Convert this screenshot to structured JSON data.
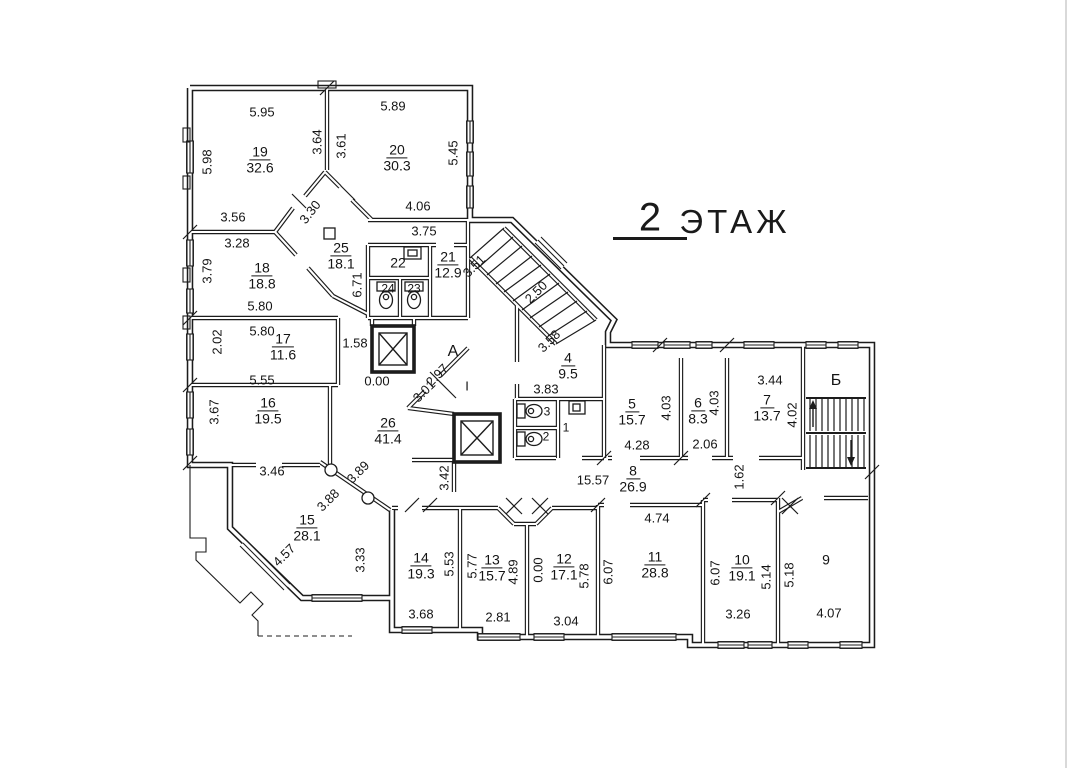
{
  "title": {
    "number": "2",
    "word": "ЭТАЖ"
  },
  "letters": [
    {
      "t": "А"
    },
    {
      "t": "Б"
    },
    {
      "t": "I"
    }
  ],
  "rooms": [
    {
      "n": "19",
      "a": "32.6"
    },
    {
      "n": "20",
      "a": "30.3"
    },
    {
      "n": "25",
      "a": "18.1"
    },
    {
      "n": "22"
    },
    {
      "n": "21",
      "a": "12.9"
    },
    {
      "n": "24"
    },
    {
      "n": "23"
    },
    {
      "n": "18",
      "a": "18.8"
    },
    {
      "n": "17",
      "a": "11.6"
    },
    {
      "n": "16",
      "a": "19.5"
    },
    {
      "n": "26",
      "a": "41.4"
    },
    {
      "n": "15",
      "a": "28.1"
    },
    {
      "n": "4",
      "a": "9.5"
    },
    {
      "n": "3"
    },
    {
      "n": "2"
    },
    {
      "n": "1"
    },
    {
      "n": "5",
      "a": "15.7"
    },
    {
      "n": "6",
      "a": "8.3"
    },
    {
      "n": "7",
      "a": "13.7"
    },
    {
      "n": "8",
      "a": "26.9"
    },
    {
      "n": "14",
      "a": "19.3"
    },
    {
      "n": "13",
      "a": "15.7"
    },
    {
      "n": "12",
      "a": "17.1"
    },
    {
      "n": "11",
      "a": "28.8"
    },
    {
      "n": "10",
      "a": "19.1"
    },
    {
      "n": "9"
    }
  ],
  "dims": [
    "5.95",
    "5.89",
    "3.56",
    "3.28",
    "4.06",
    "3.75",
    "5.80",
    "5.80",
    "5.55",
    "1.58",
    "0.00",
    "3.83",
    "3.46",
    "15.57",
    "4.74",
    "3.68",
    "2.81",
    "3.04",
    "3.26",
    "4.07",
    "2.06",
    "4.28",
    "3.44",
    "5.98",
    "3.64",
    "3.61",
    "5.45",
    "3.79",
    "2.02",
    "6.71",
    "3.67",
    "5.53",
    "5.77",
    "4.89",
    "0.00",
    "5.78",
    "6.07",
    "6.07",
    "5.14",
    "5.18",
    "4.03",
    "4.03",
    "4.02",
    "1.62",
    "3.42",
    "3.33",
    "2.50",
    "3.51",
    "3.58",
    "2.97",
    "3.01",
    "3.89",
    "3.88",
    "4.57",
    "3.30"
  ],
  "colors": {
    "ink": "#1c1c1c",
    "paper": "#ffffff"
  }
}
